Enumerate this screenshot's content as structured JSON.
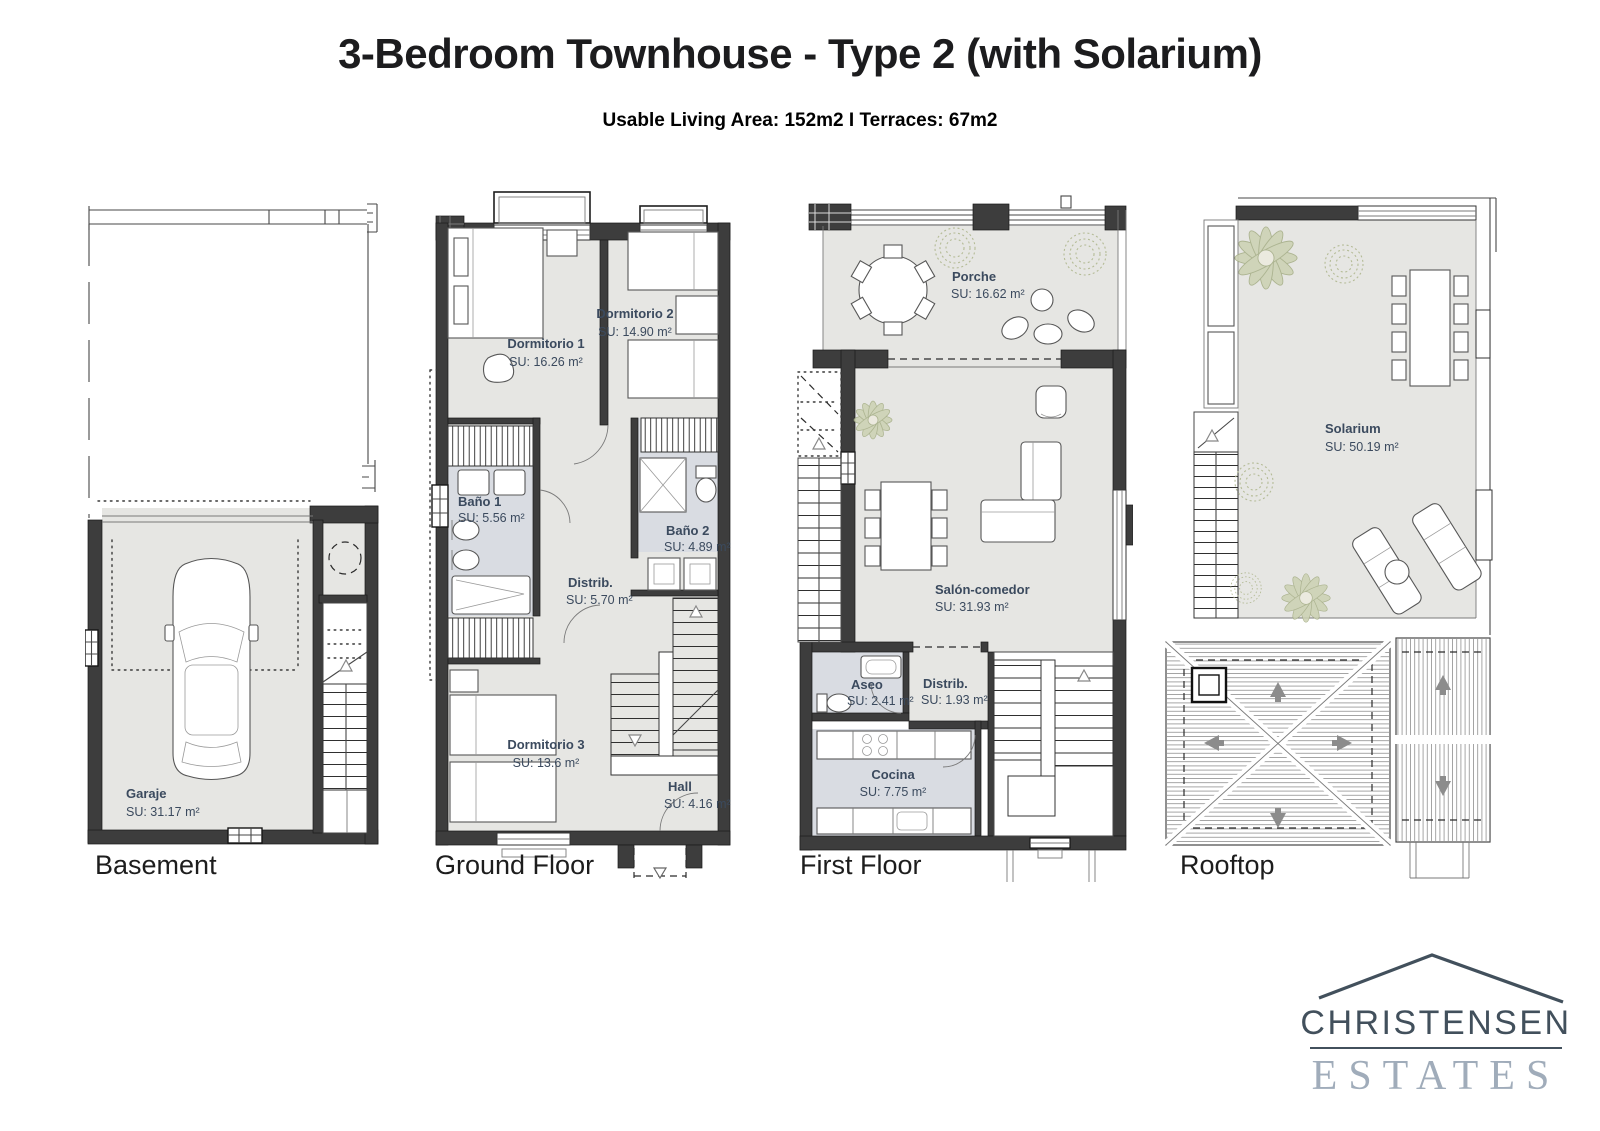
{
  "header": {
    "title": "3-Bedroom Townhouse - Type 2 (with Solarium)",
    "subtitle": "Usable Living Area: 152m2 I Terraces: 67m2"
  },
  "plans": {
    "basement": {
      "label": "Basement",
      "rooms": {
        "garaje": {
          "name": "Garaje",
          "area": "SU: 31.17 m²"
        }
      }
    },
    "ground": {
      "label": "Ground Floor",
      "rooms": {
        "dormitorio1": {
          "name": "Dormitorio 1",
          "area": "SU: 16.26 m²"
        },
        "dormitorio2": {
          "name": "Dormitorio 2",
          "area": "SU: 14.90 m²"
        },
        "bano1": {
          "name": "Baño 1",
          "area": "SU: 5.56 m²"
        },
        "bano2": {
          "name": "Baño 2",
          "area": "SU: 4.89 m²"
        },
        "distrib": {
          "name": "Distrib.",
          "area": "SU: 5.70 m²"
        },
        "dormitorio3": {
          "name": "Dormitorio 3",
          "area": "SU: 13.6 m²"
        },
        "hall": {
          "name": "Hall",
          "area": "SU: 4.16 m²"
        }
      }
    },
    "first": {
      "label": "First Floor",
      "rooms": {
        "porche": {
          "name": "Porche",
          "area": "SU: 16.62 m²"
        },
        "salon": {
          "name": "Salón-comedor",
          "area": "SU: 31.93 m²"
        },
        "aseo": {
          "name": "Aseo",
          "area": "SU: 2.41 m²"
        },
        "distrib": {
          "name": "Distrib.",
          "area": "SU: 1.93 m²"
        },
        "cocina": {
          "name": "Cocina",
          "area": "SU: 7.75 m²"
        }
      }
    },
    "rooftop": {
      "label": "Rooftop",
      "rooms": {
        "solarium": {
          "name": "Solarium",
          "area": "SU: 50.19 m²"
        }
      }
    }
  },
  "logo": {
    "line1": "CHRISTENSEN",
    "line2": "ESTATES"
  },
  "colors": {
    "ink": "#1c1c1e",
    "roomlabel": "#3b4a5e",
    "wall": "#3d3d3d",
    "room": "#e6e6e3",
    "wet": "#d9dce2",
    "logodark": "#42505c",
    "logolight": "#a0acba"
  }
}
